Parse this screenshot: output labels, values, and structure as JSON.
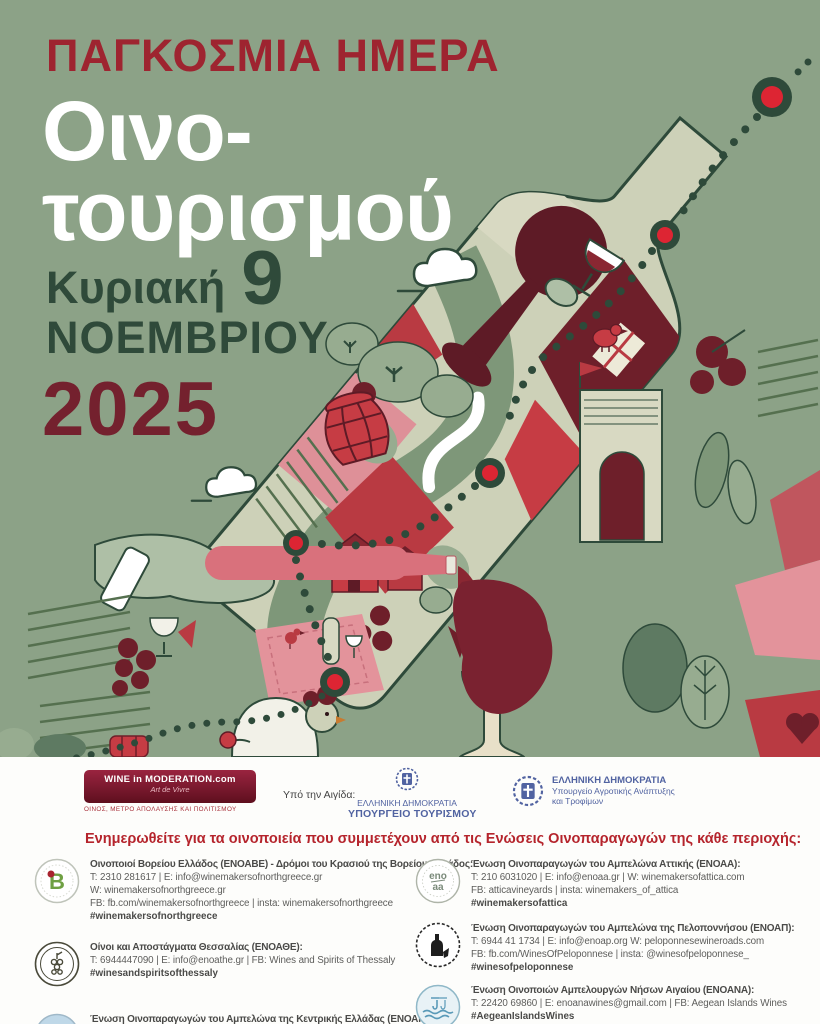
{
  "poster": {
    "title_line1": "ΠΑΓΚΟΣΜΙΑ ΗΜΕΡΑ",
    "title_line2a": "Οινο-",
    "title_line2b": "τουρισμού",
    "date_day": "Κυριακή",
    "date_number": "9",
    "date_month": "ΝΟΕΜΒΡΙΟΥ",
    "date_year": "2025",
    "colors": {
      "background_green": "#8CA287",
      "title_red": "#9E2430",
      "subtitle_white": "#FFFFFF",
      "date_green": "#2F4A3A",
      "year_maroon": "#74212E",
      "marker_red": "#DD2533",
      "heading_red": "#B5242C",
      "ministry_blue": "#5163A1"
    },
    "illustration_icons": [
      "wine-bottle",
      "route-dots",
      "map-marker",
      "cloud",
      "barrel",
      "red-bird",
      "wine-glass",
      "pouring-bottle-hand",
      "picnic-blanket",
      "goose",
      "vineyard-rows",
      "arch-tower",
      "houses",
      "trees"
    ]
  },
  "sponsors": {
    "wim": {
      "line1": "WINE in MODERATION.com",
      "line2": "Art de Vivre",
      "tagline": "ΟΙΝΟΣ, ΜΕΤΡΟ ΑΠΟΛΑΥΣΗΣ ΚΑΙ ΠΟΛΙΤΙΣΜΟΥ"
    },
    "aegis_label": "Υπό την Αιγίδα:",
    "tourism": {
      "line1": "ΕΛΛΗΝΙΚΗ ΔΗΜΟΚΡΑΤΙΑ",
      "line2": "ΥΠΟΥΡΓΕΙΟ ΤΟΥΡΙΣΜΟΥ"
    },
    "agriculture": {
      "line1": "ΕΛΛΗΝΙΚΗ ΔΗΜΟΚΡΑΤΙΑ",
      "line2": "Υπουργείο Αγροτικής Ανάπτυξης",
      "line3": "και Τροφίμων"
    }
  },
  "directory": {
    "heading": "Ενημερωθείτε για τα οινοποιεία που συμμετέχουν από τις Ενώσεις Οινοπαραγωγών της κάθε περιοχής:",
    "left": [
      {
        "logo_name": "enoave-logo",
        "title": "Οινοποιοί Βορείου Ελλάδος (ΕΝΟΑΒΕ) - Δρόμοι του Κρασιού της Βορείου Ελλάδος:",
        "lines": [
          "T: 2310 281617 | E: info@winemakersofnorthgreece.gr",
          "W: winemakersofnorthgreece.gr",
          "FB: fb.com/winemakersofnorthgreece | insta: winemakersofnorthgreece"
        ],
        "hashtag": "#winemakersofnorthgreece"
      },
      {
        "logo_name": "thessaly-logo",
        "title": "Οίνοι και Αποστάγματα Θεσσαλίας (ΕΝΟΑΘΕ):",
        "lines": [
          "T: 6944447090 | E: info@enoathe.gr | FB: Wines and Spirits of Thessaly"
        ],
        "hashtag": "#winesandspiritsofthessaly"
      },
      {
        "logo_name": "enoake-logo",
        "title": "Ένωση Οινοπαραγωγών του Αμπελώνα της Κεντρικής Ελλάδας (ΕΝΟΑΚΕ):",
        "lines": [
          "E: info@… | W: …"
        ],
        "hashtag": ""
      }
    ],
    "right": [
      {
        "logo_name": "enoaa-logo",
        "title": "Ένωση Οινοπαραγωγών του Αμπελώνα Αττικής (ΕΝΟΑΑ):",
        "lines": [
          "T: 210 6031020 | E: info@enoaa.gr | W: winemakersofattica.com",
          "FB: atticavineyards | insta: winemakers_of_attica"
        ],
        "hashtag": "#winemakersofattica"
      },
      {
        "logo_name": "enoap-logo",
        "title": "Ένωση Οινοπαραγωγών του Αμπελώνα της Πελοποννήσου (ΕΝΟΑΠ):",
        "lines": [
          "T: 6944 41 1734 | E: info@enoap.org W: peloponnesewineroads.com",
          "FB: fb.com/WinesOfPeloponnese | insta: @winesofpeloponnese_"
        ],
        "hashtag": "#winesofpeloponnese"
      },
      {
        "logo_name": "enoana-logo",
        "title": "Ένωση Οινοποιών Αμπελουργών Νήσων Αιγαίου (ΕΝΟΑΝΑ):",
        "lines": [
          "T: 22420 69860 | E: enoanawines@gmail.com | FB: Aegean Islands Wines"
        ],
        "hashtag": "#AegeanIslandsWines"
      }
    ]
  }
}
